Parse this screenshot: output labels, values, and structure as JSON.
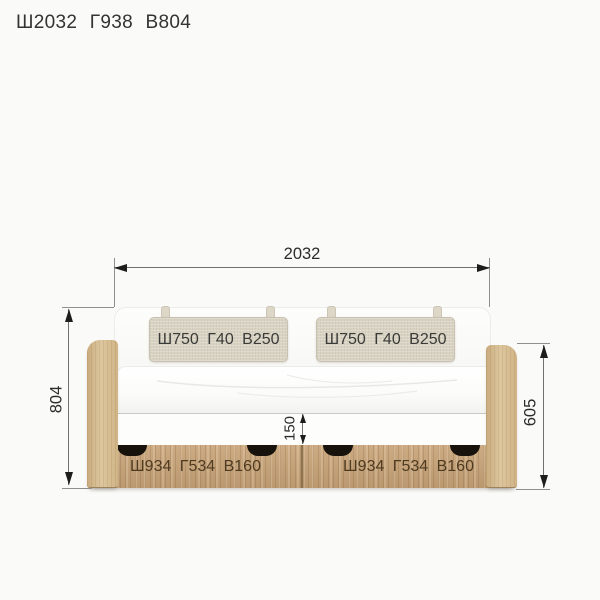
{
  "page": {
    "title": "Ш2032 Г938 В804"
  },
  "dimensions": {
    "overall_width": "2032",
    "overall_height": "804",
    "side_height": "605",
    "rail_height": "150"
  },
  "bed": {
    "cushions": [
      {
        "label": "Ш750 Г40 В250"
      },
      {
        "label": "Ш750 Г40 В250"
      }
    ],
    "drawers": [
      {
        "label": "Ш934 Г534 В160"
      },
      {
        "label": "Ш934 Г534 В160"
      }
    ]
  },
  "colors": {
    "background": "#fafaf8",
    "wood_drawer": "#c7a276",
    "wood_side": "#d5ba8e",
    "cushion": "#d8d2c2",
    "mattress": "#ffffff",
    "handle": "#17120b",
    "dimension_line": "#6f6f6d",
    "arrow": "#1d1d1b",
    "title_text": "#333331",
    "drawer_text": "#4e3a20"
  }
}
